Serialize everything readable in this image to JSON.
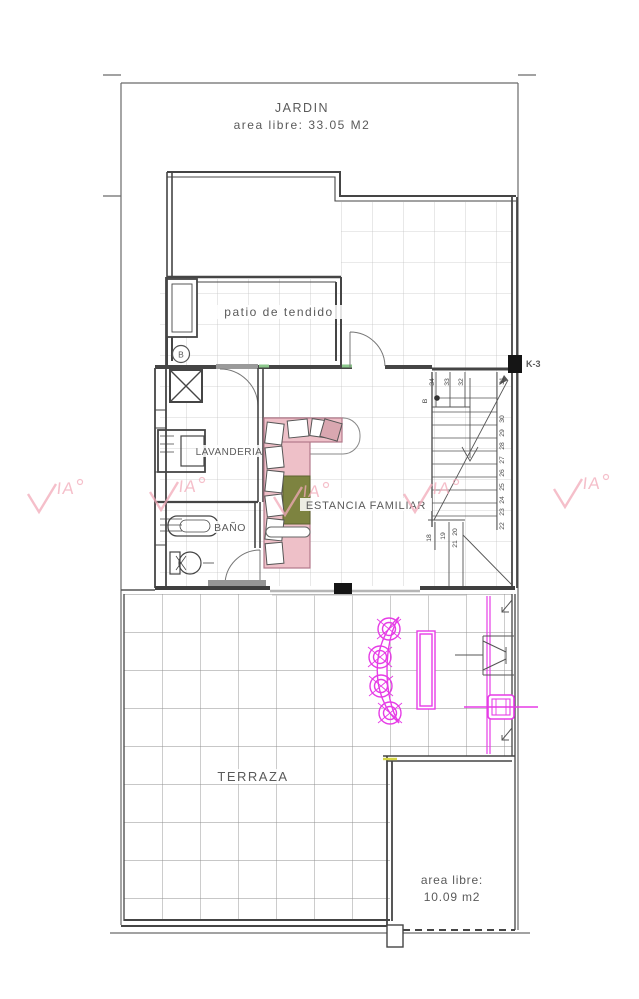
{
  "watermark": {
    "text": "VIA",
    "suffix_text": "IA",
    "color": "#f2aab9",
    "count": 5
  },
  "rooms": {
    "jardin": {
      "name": "JARDIN",
      "area": "area libre: 33.05 M2"
    },
    "patio": {
      "name": "patio de tendido"
    },
    "lavanderia": {
      "name": "LAVANDERIA"
    },
    "bano": {
      "name": "BAÑO"
    },
    "estancia": {
      "name": "ESTANCIA FAMILIAR"
    },
    "terraza": {
      "name": "TERRAZA",
      "area_line1": "area libre:",
      "area_line2": "10.09 m2"
    }
  },
  "annotations": {
    "column_tag": "K-3",
    "stair_point": "B",
    "patio_point": "B"
  },
  "stairs": {
    "top": [
      "34",
      "33",
      "32"
    ],
    "right": [
      "31",
      "30",
      "29",
      "28",
      "27",
      "26",
      "25",
      "24",
      "23",
      "22"
    ],
    "lower": [
      "18",
      "19",
      "20",
      "21"
    ]
  },
  "colors": {
    "wall": "#454545",
    "grid_small": "#c6c6c6",
    "grid_large": "#8f8f8f",
    "sofa_pink": "#eec0c8",
    "cushion_olive": "#7d8340",
    "furniture_magenta": "#e63ce6",
    "watermark_pink": "#f2aab9",
    "threshold_green": "#8bc78b",
    "column_black": "#151515"
  }
}
